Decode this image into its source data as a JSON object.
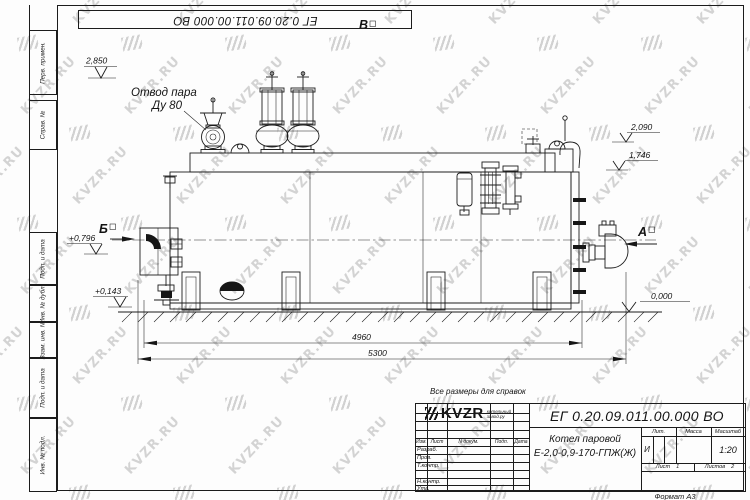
{
  "watermark": {
    "text": "KVZR.RU"
  },
  "margin_labels": [
    "Перв. примен.",
    "Справ. №",
    "Подп. и дата",
    "Инв. № дубл.",
    "Взам. инв. №",
    "Подп. и дата",
    "Инв. № подл."
  ],
  "sheet": {
    "note": "Все размеры для справок",
    "format_label": "Формат А3"
  },
  "drawing": {
    "labels": {
      "steam_outlet_line1": "Отвод пара",
      "steam_outlet_line2": "Ду 80",
      "view_a": "А",
      "view_b": "Б",
      "view_v": "В",
      "dim_2850": "2,850",
      "dim_2090": "2,090",
      "dim_1746": "1,746",
      "dim_0000": "0,000",
      "elev_0796": "+0,796",
      "elev_0143": "+0,143",
      "dim_4960": "4960",
      "dim_5300": "5300"
    }
  },
  "title_block": {
    "doc_number": "ЕГ 0.20.09.011.00.000  ВО",
    "product_line1": "Котел паровой",
    "product_line2": "Е-2,0-0,9-170-ГПЖ(Ж)",
    "rev_headers": {
      "izm": "Изм.",
      "list": "Лист",
      "doc": "N докум.",
      "podp": "Подп.",
      "data": "Дата"
    },
    "sign_rows": [
      "Разраб.",
      "Пров.",
      "Т.контр.",
      "Н.контр.",
      "Утв."
    ],
    "lit_header": "Лит.",
    "mass_header": "Масса",
    "scale_header": "Масштаб",
    "lit_value": "И",
    "scale_value": "1:20",
    "sheet_label": "Лист",
    "sheet_number": "1",
    "sheets_label": "Листов",
    "sheets_count": "2",
    "logo_text": "KVZR",
    "logo_sub1": "котельный",
    "logo_sub2": "завод.ру"
  }
}
